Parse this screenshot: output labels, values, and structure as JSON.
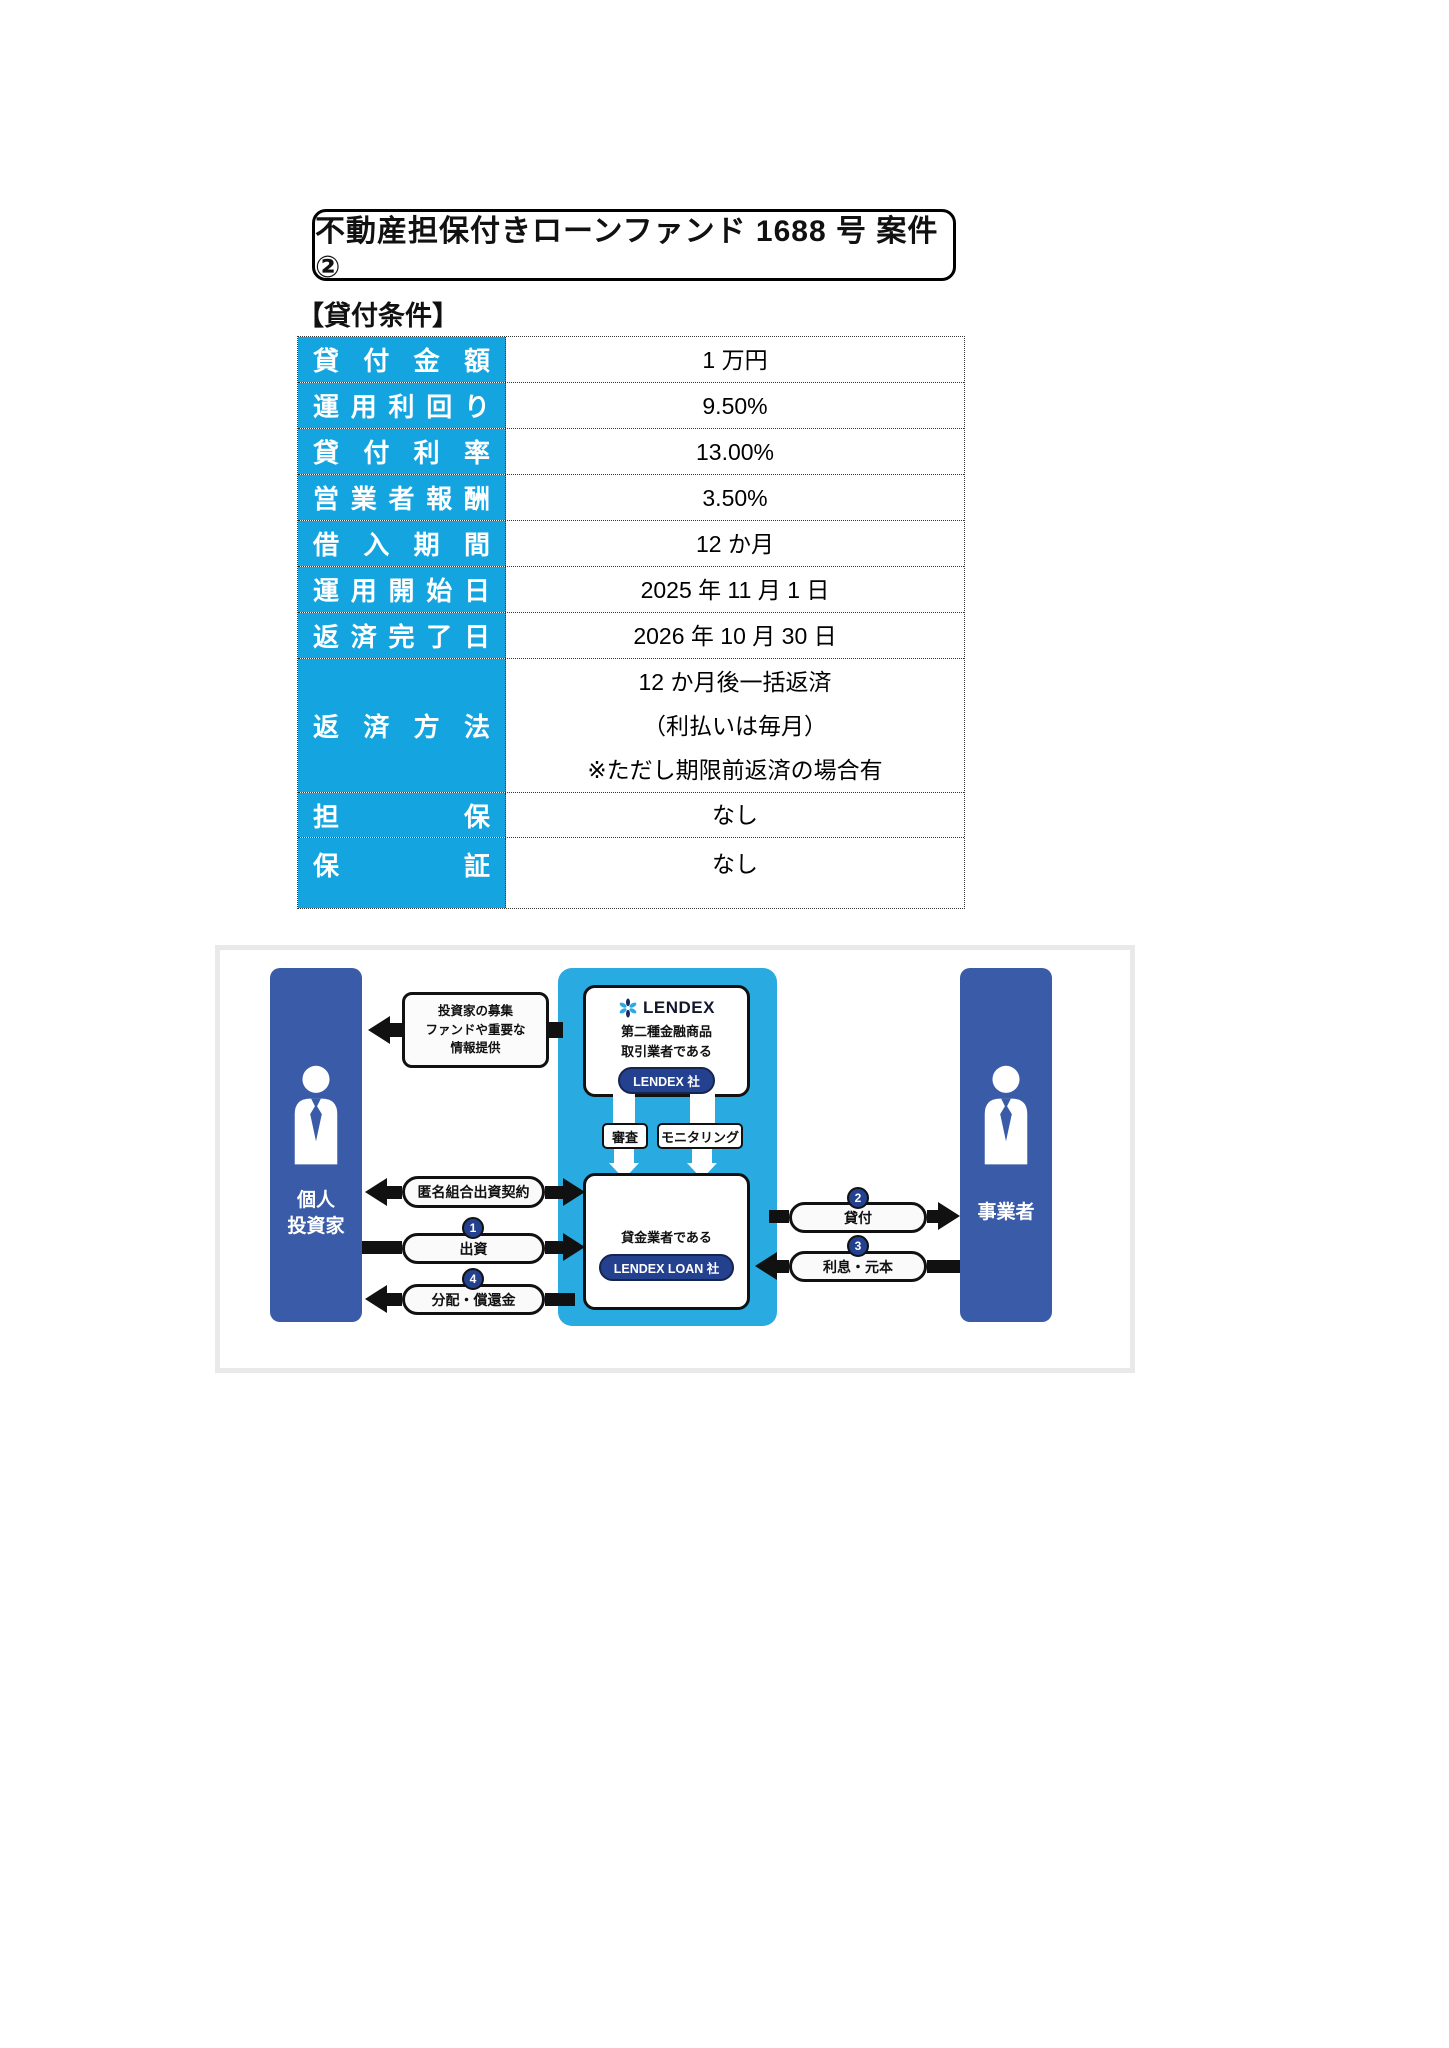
{
  "page": {
    "title": "不動産担保付きローンファンド 1688 号 案件②",
    "section_heading": "【貸付条件】"
  },
  "loan_table": {
    "rows": [
      {
        "label": "貸付金額",
        "value": "1 万円"
      },
      {
        "label": "運用利回り",
        "value": "9.50%"
      },
      {
        "label": "貸付利率",
        "value": "13.00%"
      },
      {
        "label": "営業者報酬",
        "value": "3.50%"
      },
      {
        "label": "借入期間",
        "value": "12 か月"
      },
      {
        "label": "運用開始日",
        "value": "2025 年 11 月 1 日"
      },
      {
        "label": "返済完了日",
        "value": "2026 年 10 月 30 日"
      },
      {
        "label": "返済方法",
        "value_line1": "12 か月後一括返済",
        "value_line2": "（利払いは毎月）",
        "value_line3": "※ただし期限前返済の場合有"
      },
      {
        "label": "担保",
        "value": "なし"
      },
      {
        "label": "保証",
        "value": "なし"
      }
    ]
  },
  "diagram": {
    "investor": {
      "line1": "個人",
      "line2": "投資家"
    },
    "borrower": "事業者",
    "lendex_box": {
      "brand": "LENDEX",
      "desc_line1": "第二種金融商品",
      "desc_line2": "取引業者である",
      "badge": "LENDEX 社"
    },
    "loan_company_box": {
      "desc": "貸金業者である",
      "badge": "LENDEX LOAN 社"
    },
    "info_box": {
      "line1": "投資家の募集",
      "line2": "ファンドや重要な",
      "line3": "情報提供"
    },
    "screening_label": "審査",
    "monitoring_label": "モニタリング",
    "flows": {
      "anonymous_contract": "匿名組合出資契約",
      "investment": {
        "step": "1",
        "label": "出資"
      },
      "lending": {
        "step": "2",
        "label": "貸付"
      },
      "interest_principal": {
        "step": "3",
        "label": "利息・元本"
      },
      "distribution": {
        "step": "4",
        "label": "分配・償還金"
      }
    },
    "colors": {
      "pillar_navy": "#3a5ba8",
      "cyan": "#29abe2",
      "badge_navy": "#24418f",
      "table_cyan": "#14a5e0",
      "logo_navy": "#1b2a5e"
    }
  }
}
